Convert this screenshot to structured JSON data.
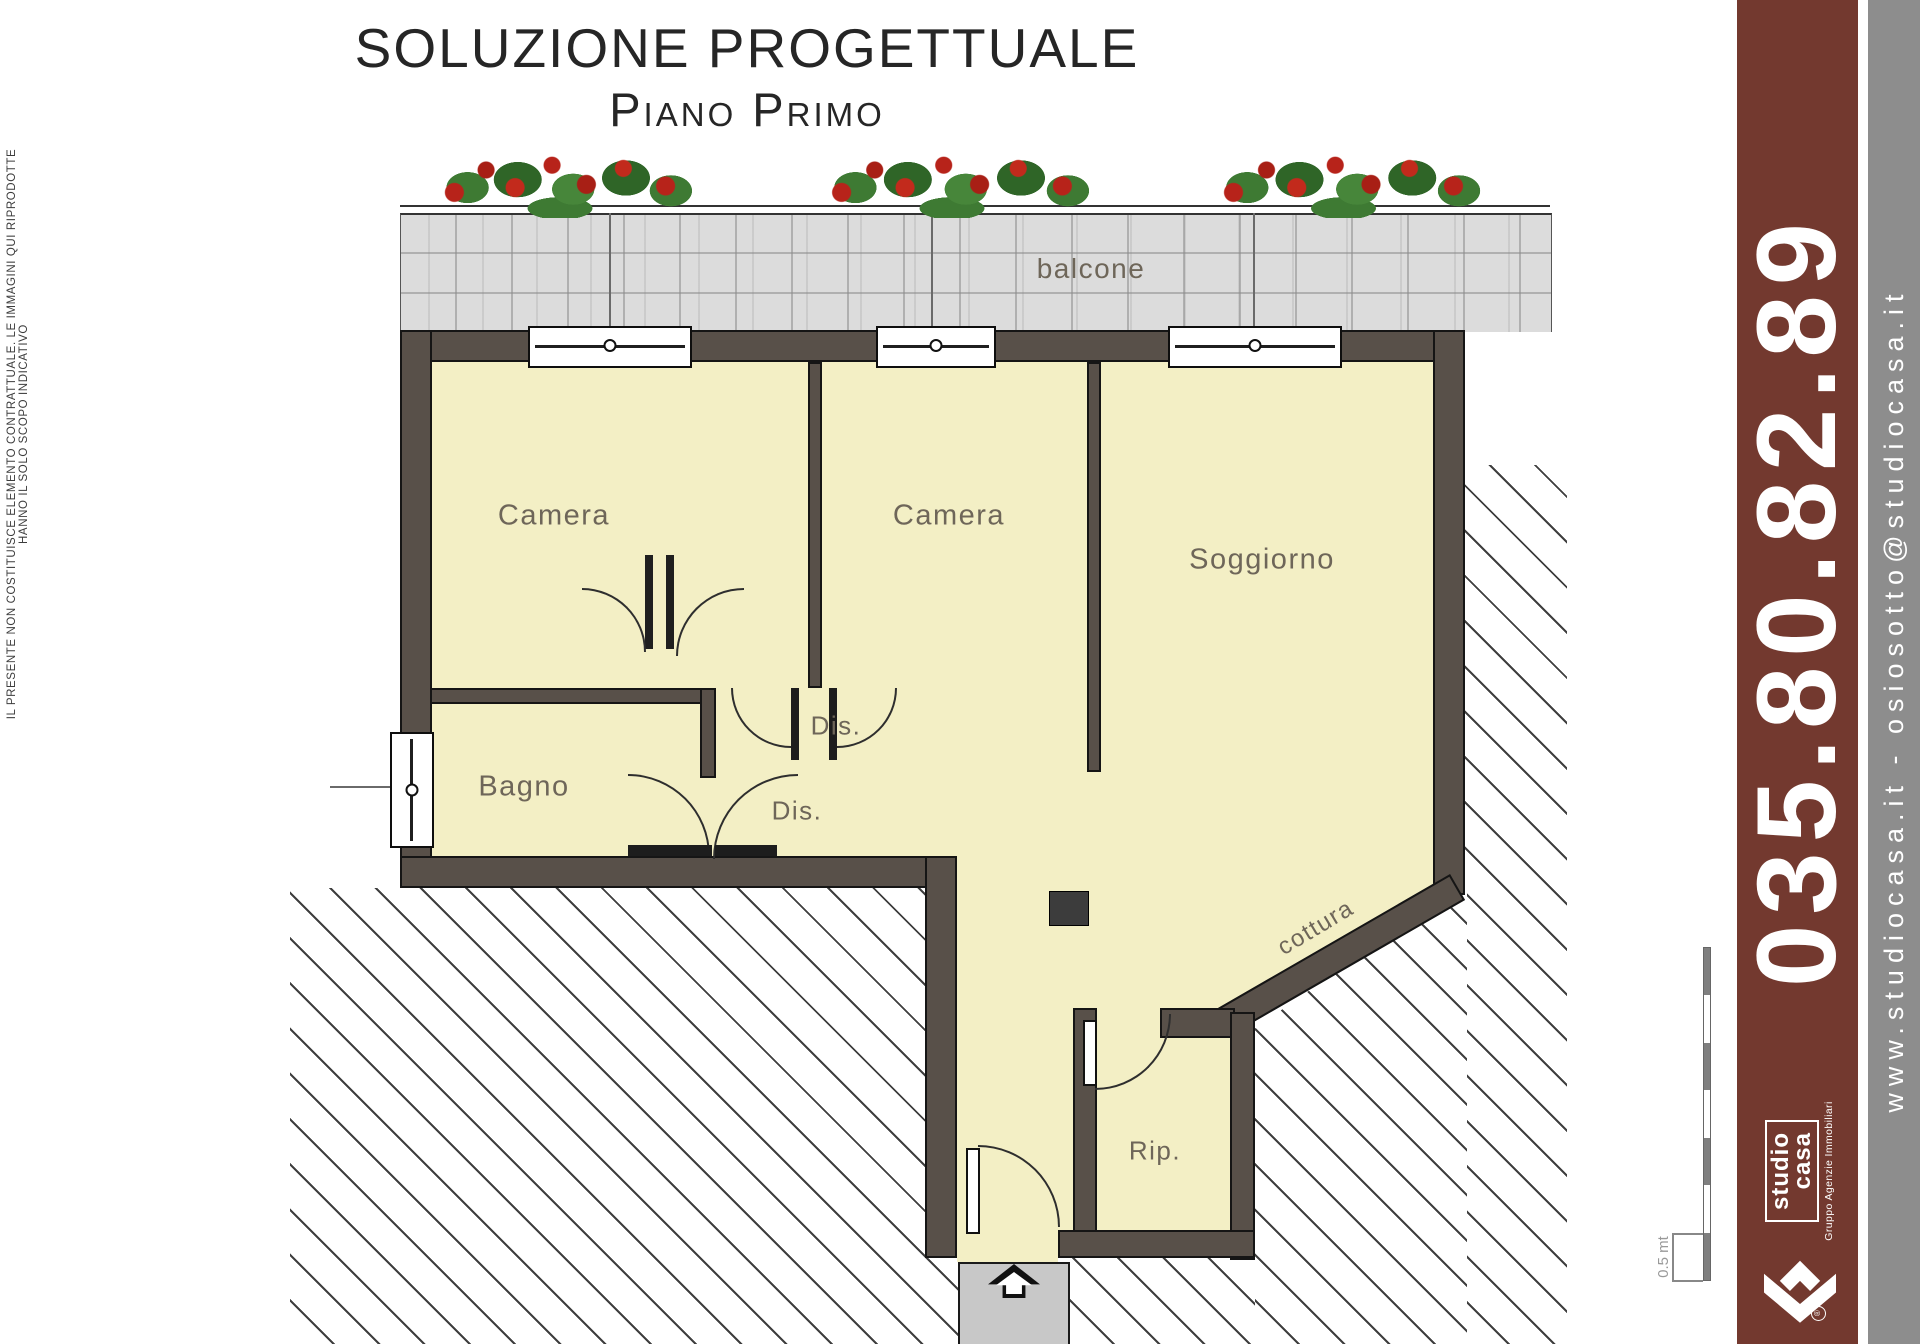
{
  "page": {
    "title": "SOLUZIONE PROGETTUALE",
    "subtitle": "Piano Primo"
  },
  "disclaimer": "IL PRESENTE NON COSTITUISCE ELEMENTO CONTRATTUALE. LE IMMAGINI QUI RIPRODOTTE HANNO IL SOLO SCOPO INDICATIVO",
  "plan": {
    "labels": {
      "balcony": "balcone",
      "camera1": "Camera",
      "camera2": "Camera",
      "living": "Soggiorno",
      "bath": "Bagno",
      "hall_upper": "Dis.",
      "hall_lower": "Dis.",
      "storage": "Rip.",
      "kitchen": "cottura"
    },
    "scale": {
      "label": "0.5 mt"
    }
  },
  "sidebar": {
    "phone": "035.80.82.89",
    "website": "www.studiocasa.it - osiosotto@studiocasa.it",
    "logo": {
      "name_line1": "studio",
      "name_line2": "casa",
      "tagline": "Gruppo Agenzie Immobiliari"
    },
    "colors": {
      "maroon": "#73392F",
      "gray": "#8D8D8D"
    }
  },
  "colors": {
    "wall": "#585049",
    "room_fill": "#F3EFC5",
    "stone": "#DCDCDC",
    "flower_red": "#B7231A",
    "foliage_green": "#3E7A33",
    "label_text": "#6E6659"
  }
}
